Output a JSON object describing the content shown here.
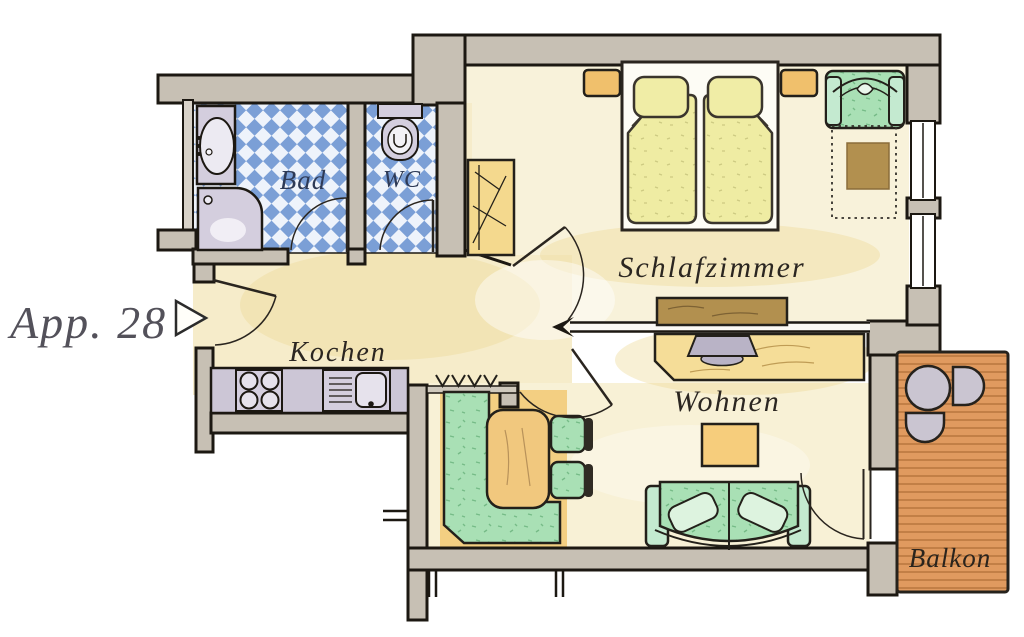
{
  "plan": {
    "unit_label": "App. 28",
    "rooms": {
      "bad": "Bad",
      "wc": "WC",
      "kochen": "Kochen",
      "schlafzimmer": "Schlafzimmer",
      "wohnen": "Wohnen",
      "balkon": "Balkon"
    },
    "colors": {
      "wall": "#c7c0b4",
      "outline": "#1c1812",
      "floor_cream": "#f8f2da",
      "floor_hall": "#f6ecca",
      "tile_blue": "#7b9fd6",
      "tile_white": "#eef3fb",
      "furniture_green": "#a9e0b5",
      "bed_yellow": "#efeca3",
      "nightstand_orange": "#f0c06c",
      "wood_orange": "#f1c87e",
      "wood_brown": "#b2904f",
      "balcony_wood": "#e09a5f",
      "fixture_gray": "#d4cede",
      "label_ink": "#2b2621",
      "bath_label_ink": "#2e3a56",
      "unit_label_ink": "#53515a"
    },
    "furniture": [
      "sink",
      "shower",
      "toilet",
      "wardrobe",
      "double-bed",
      "pillows",
      "nightstands",
      "armchair",
      "side-table",
      "sideboard",
      "stove",
      "kitchen-sink",
      "tv-desk",
      "tv",
      "coffee-table",
      "sofa",
      "corner-bench",
      "dining-table",
      "dining-chairs",
      "balcony-table",
      "balcony-chairs"
    ]
  }
}
